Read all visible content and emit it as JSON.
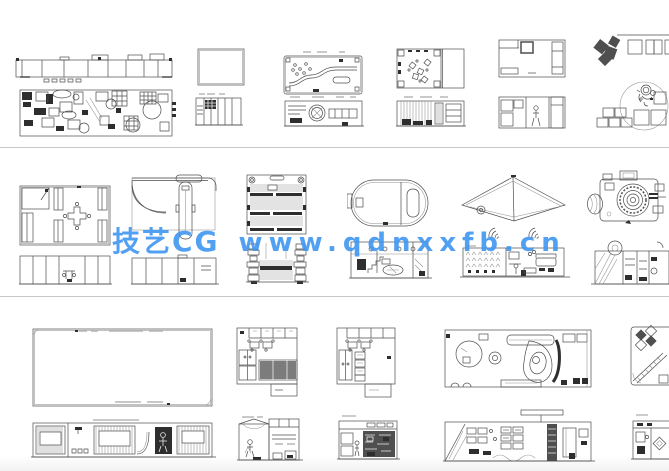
{
  "watermark": {
    "brand": "技艺CG",
    "url": "www.qdnxxfb.cn",
    "color": "#3f96f0"
  },
  "canvas": {
    "background": "#ffffff",
    "divider_color": "#c6c6c6",
    "line_color": "#4d4d4d",
    "dark_fill": "#2e2e2e"
  },
  "drawings": {
    "long_booth": "long exhibition booth elevation and dense floor plan",
    "small_room_plan": "small rectangular room plan",
    "small_room_elevation": "small room elevation with striped wall",
    "s_path_plan": "floor plan with serpentine path",
    "s_path_elevation": "elevation with circular fan detail",
    "tables_plan": "floor plan with scattered tables",
    "tables_elevation": "striped elevation with hatched column",
    "corner_room_plan": "room plan with heavy corner counter",
    "corner_room_elevation": "elevation with person figure",
    "pinwheel_blocks": "dark pinwheel blocks and wall squares",
    "mascot_circle": "mascot sketch in circle with stacked cubes",
    "cross_table_plan": "plan with cross-shaped center table",
    "cross_table_elevation": "elevation with center table and chairs",
    "curve_plan": "plan with large curved partition",
    "curve_elevation": "paneled elevation",
    "striped_plan": "striped stage plan with corner posts",
    "striped_elevation": "elevation with stacked side towers",
    "oval_plan": "oval booth plan",
    "oval_elevation": "elevation with stairs and counter",
    "chevron_plan": "chevron canopy plan with arc marks",
    "chevron_elevation": "detailed elevation with sofa",
    "camera_plan": "camera-shaped booth drawing",
    "camera_elevation": "camera booth elevation",
    "big_room_plan": "large empty hall plan",
    "big_room_elevation": "hall elevation with screens and dark doorway",
    "closet_plan_1": "square plan with closets and hatched floor",
    "closet_elevation_1": "gabled elevation with figure",
    "closet_plan_2": "square plan with closets and shelf column",
    "closet_elevation_2": "elevation with dark shelving wall",
    "curvy_plan": "long plan with circles and curved counter",
    "curvy_elevation": "long elevation with signboard and dark column",
    "stairs_plan": "plan with diamond pattern and stairs",
    "stairs_elevation": "elevation with diamond panel"
  }
}
